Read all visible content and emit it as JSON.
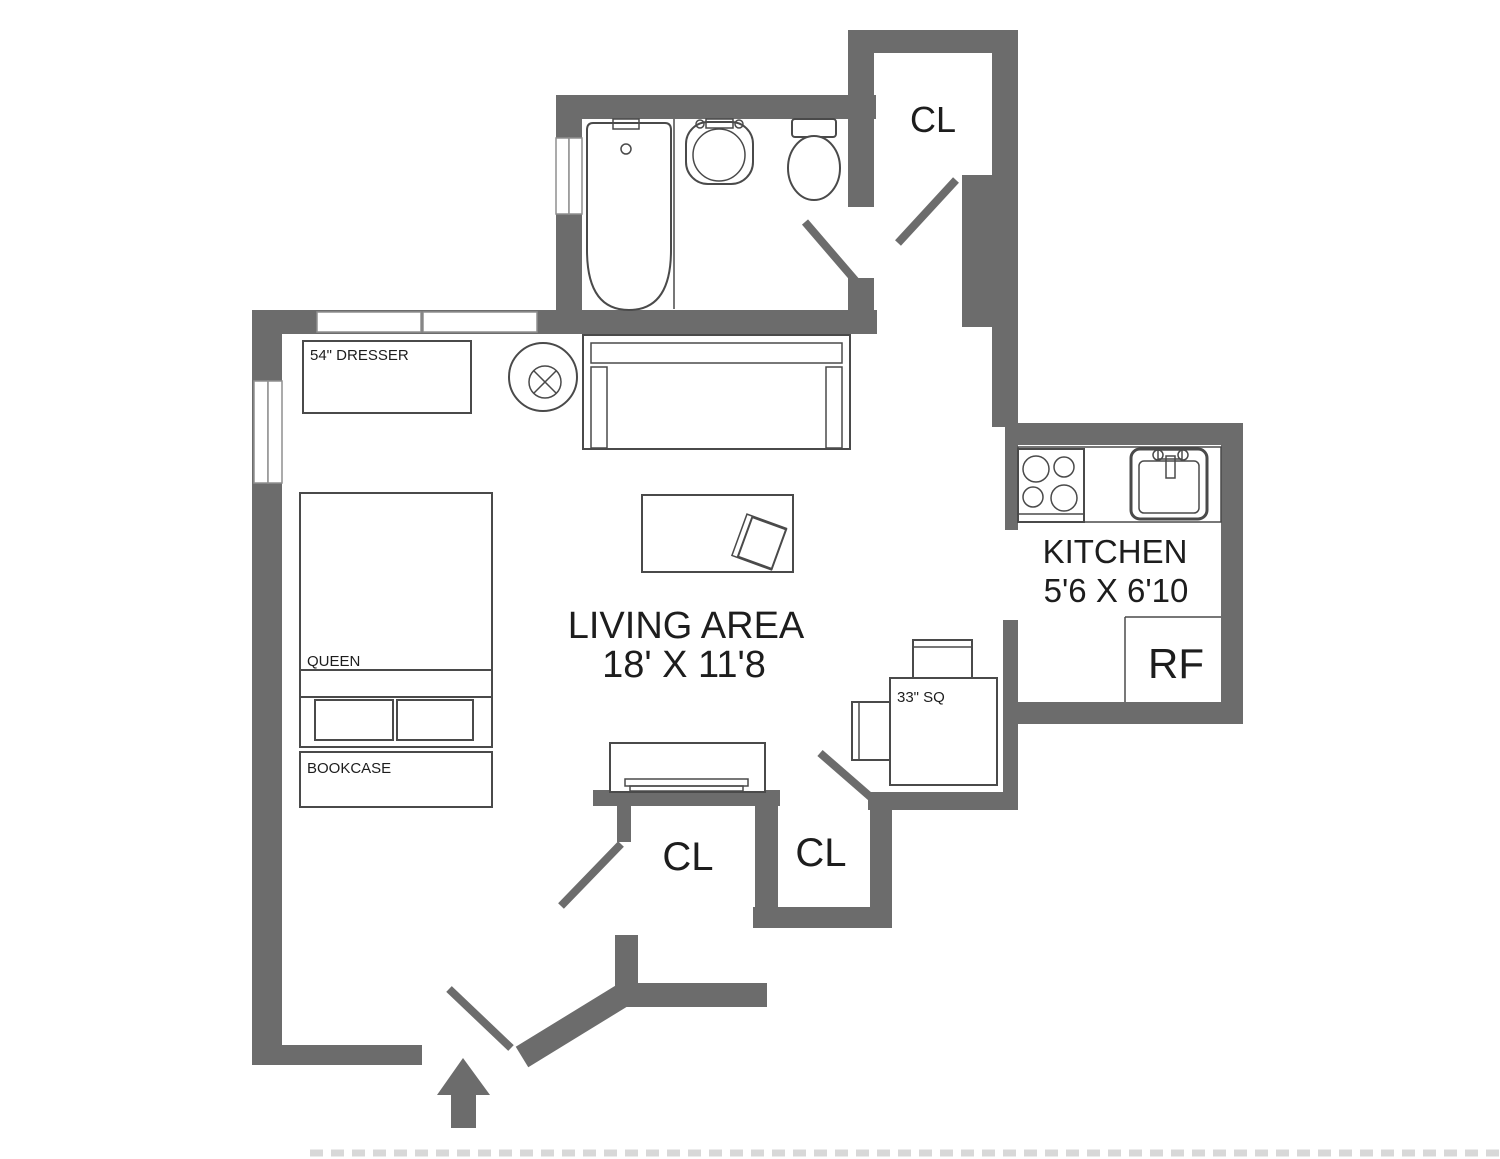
{
  "title": "Studio apartment floor plan",
  "colors": {
    "wall": "#6c6c6c",
    "line": "#4a4a4a",
    "text": "#1d1d1d",
    "frame": "#8f8f8f",
    "watermark": "#cfcfcf"
  },
  "rooms": {
    "living": {
      "label": "LIVING AREA",
      "dimensions": "18' X 11'8"
    },
    "kitchen": {
      "label": "KITCHEN",
      "dimensions": "5'6 X 6'10"
    },
    "refrigerator": {
      "label": "RF"
    },
    "closet_top": {
      "label": "CL"
    },
    "closet_bottom_left": {
      "label": "CL"
    },
    "closet_bottom_right": {
      "label": "CL"
    }
  },
  "furniture": {
    "dresser": {
      "label": "54\" DRESSER"
    },
    "bed": {
      "label": "QUEEN"
    },
    "bookcase": {
      "label": "BOOKCASE"
    },
    "table": {
      "label": "33\" SQ"
    }
  }
}
